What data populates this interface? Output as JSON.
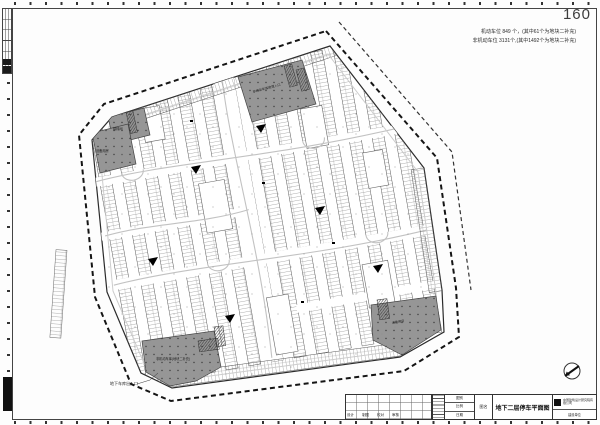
{
  "page": {
    "number": "160"
  },
  "annotations": {
    "stats_line1": "机动车位 849 个，(其中61个为地块二补充)",
    "stats_line2": "非机动车位 3131个,(其中1492个为地块二补充)",
    "exit_label": "地下车库出入口"
  },
  "plan": {
    "cores": {
      "top": "非机动车库坡道入口",
      "left_small": "楼梯间",
      "left_big": "设备用房",
      "bottom_left": "非机动车库(地块二补充)",
      "bottom_right": "设备用房"
    }
  },
  "title_block": {
    "sign_labels": [
      "设计",
      "制图",
      "校对",
      "审核"
    ],
    "meta": [
      {
        "label": "图别"
      },
      {
        "label": "比例"
      },
      {
        "label": "日期"
      }
    ],
    "name_label": "图名",
    "drawing_title": "地下二层停车平面图",
    "company": "中国建筑设计研究院有限公司",
    "project_label": "建设单位"
  },
  "colors": {
    "line_dark": "#2b2b2b",
    "core_gray": "#969696",
    "guide_gray": "#c2c2c2"
  }
}
